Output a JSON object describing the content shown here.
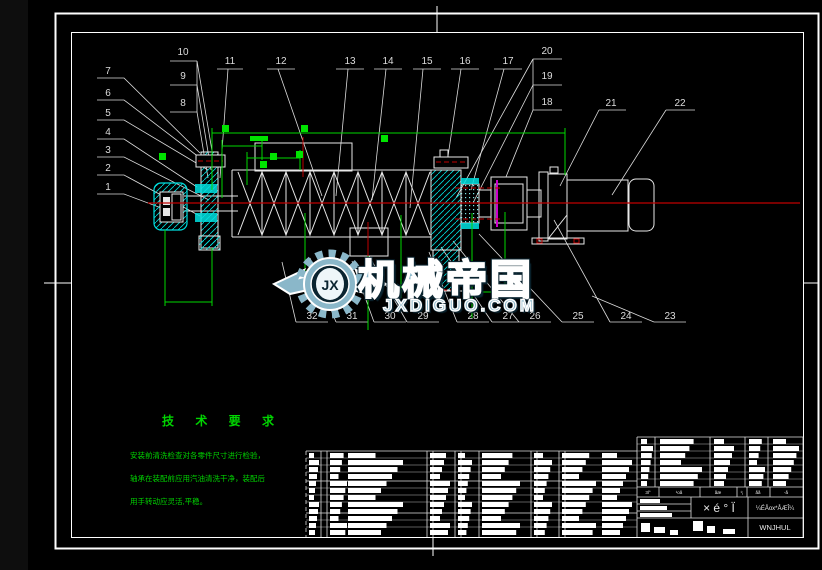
{
  "watermark": {
    "logo_monogram": "JX",
    "title": "机械帝国",
    "domain": "JXDIGUO.COM"
  },
  "tech_requirements": {
    "title": "技 术 要 求",
    "lines": [
      "安装前清洗检查对各零件尺寸进行检验，",
      "轴承在装配前应用汽油清洗干净，装配后",
      "用手转动应灵活,平稳。"
    ]
  },
  "title_block": {
    "header_labels": [
      "3l°",
      "¹oå",
      "åæ",
      "¹¡",
      "åå",
      "-­å"
    ],
    "drawing_title": "× é ° Ï",
    "info_row": "¼ÉÅox*ÅÆÎ¼",
    "company_row": "WNJHUL"
  },
  "callouts": [
    {
      "n": "1",
      "x": 108,
      "y": 190
    },
    {
      "n": "2",
      "x": 108,
      "y": 171
    },
    {
      "n": "3",
      "x": 108,
      "y": 153
    },
    {
      "n": "4",
      "x": 108,
      "y": 135
    },
    {
      "n": "5",
      "x": 108,
      "y": 116
    },
    {
      "n": "6",
      "x": 108,
      "y": 96
    },
    {
      "n": "7",
      "x": 108,
      "y": 74
    },
    {
      "n": "8",
      "x": 183,
      "y": 106
    },
    {
      "n": "9",
      "x": 183,
      "y": 79
    },
    {
      "n": "10",
      "x": 183,
      "y": 55
    },
    {
      "n": "11",
      "x": 230,
      "y": 64
    },
    {
      "n": "12",
      "x": 281,
      "y": 64
    },
    {
      "n": "13",
      "x": 350,
      "y": 64
    },
    {
      "n": "14",
      "x": 388,
      "y": 64
    },
    {
      "n": "15",
      "x": 427,
      "y": 64
    },
    {
      "n": "16",
      "x": 465,
      "y": 64
    },
    {
      "n": "17",
      "x": 508,
      "y": 64
    },
    {
      "n": "18",
      "x": 547,
      "y": 105
    },
    {
      "n": "19",
      "x": 547,
      "y": 79
    },
    {
      "n": "20",
      "x": 547,
      "y": 54
    },
    {
      "n": "21",
      "x": 611,
      "y": 106
    },
    {
      "n": "22",
      "x": 680,
      "y": 106
    },
    {
      "n": "23",
      "x": 670,
      "y": 319
    },
    {
      "n": "24",
      "x": 626,
      "y": 319
    },
    {
      "n": "25",
      "x": 578,
      "y": 319
    },
    {
      "n": "26",
      "x": 535,
      "y": 319
    },
    {
      "n": "27",
      "x": 508,
      "y": 319
    },
    {
      "n": "28",
      "x": 473,
      "y": 319
    },
    {
      "n": "29",
      "x": 423,
      "y": 319
    },
    {
      "n": "30",
      "x": 390,
      "y": 319
    },
    {
      "n": "31",
      "x": 352,
      "y": 319
    },
    {
      "n": "32",
      "x": 312,
      "y": 319
    }
  ],
  "colors": {
    "line": "#e8e8e8",
    "dimension_green": "#00d800",
    "centerline_red": "#c00000",
    "hatch_cyan": "#00dede",
    "coupling_magenta": "#cc00cc",
    "watermark_blue": "#8ab7c9"
  }
}
